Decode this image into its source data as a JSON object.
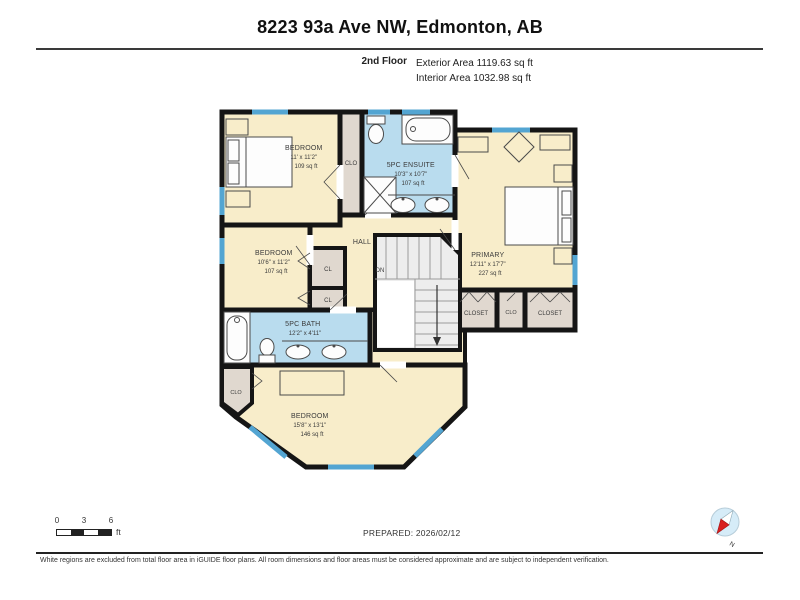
{
  "header": {
    "title": "8223 93a Ave NW, Edmonton, AB",
    "floor_label": "2nd Floor",
    "exterior_area": "Exterior Area 1119.63 sq ft",
    "interior_area": "Interior Area 1032.98 sq ft"
  },
  "floorplan": {
    "rooms": [
      {
        "name": "BEDROOM",
        "dims": "11' x 11'2\"",
        "area": "109 sq ft"
      },
      {
        "name": "5PC ENSUITE",
        "dims": "10'3\" x 10'7\"",
        "area": "107 sq ft"
      },
      {
        "name": "PRIMARY",
        "dims": "12'11\" x 17'7\"",
        "area": "227 sq ft"
      },
      {
        "name": "BEDROOM",
        "dims": "10'6\" x 11'2\"",
        "area": "107 sq ft"
      },
      {
        "name": "5PC BATH",
        "dims": "12'2\" x 4'11\"",
        "area": ""
      },
      {
        "name": "BEDROOM",
        "dims": "15'8\" x 13'1\"",
        "area": "146 sq ft"
      }
    ],
    "labels": {
      "hall": "HALL",
      "down": "DN",
      "cl_1": "CL",
      "cl_2": "CL",
      "clo_1": "CLO",
      "clo_2": "CLO",
      "clo_3": "CLO",
      "closet_left": "CLOSET",
      "closet_right": "CLOSET"
    },
    "colors": {
      "room_fill": "#f8edca",
      "wet_fill": "#b9dcee",
      "closet_fill": "#e0d8cf",
      "stair_fill": "#ededed",
      "wall": "#151515",
      "window": "#53a5d2"
    }
  },
  "scale_bar": {
    "tick_0": "0",
    "tick_3": "3",
    "tick_6": "6",
    "unit": "ft"
  },
  "prepared": "PREPARED: 2026/02/12",
  "compass": {
    "label": "N"
  },
  "footer": "White regions are excluded from total floor area in iGUIDE floor plans. All room dimensions and floor areas must be considered approximate and are subject to independent verification."
}
